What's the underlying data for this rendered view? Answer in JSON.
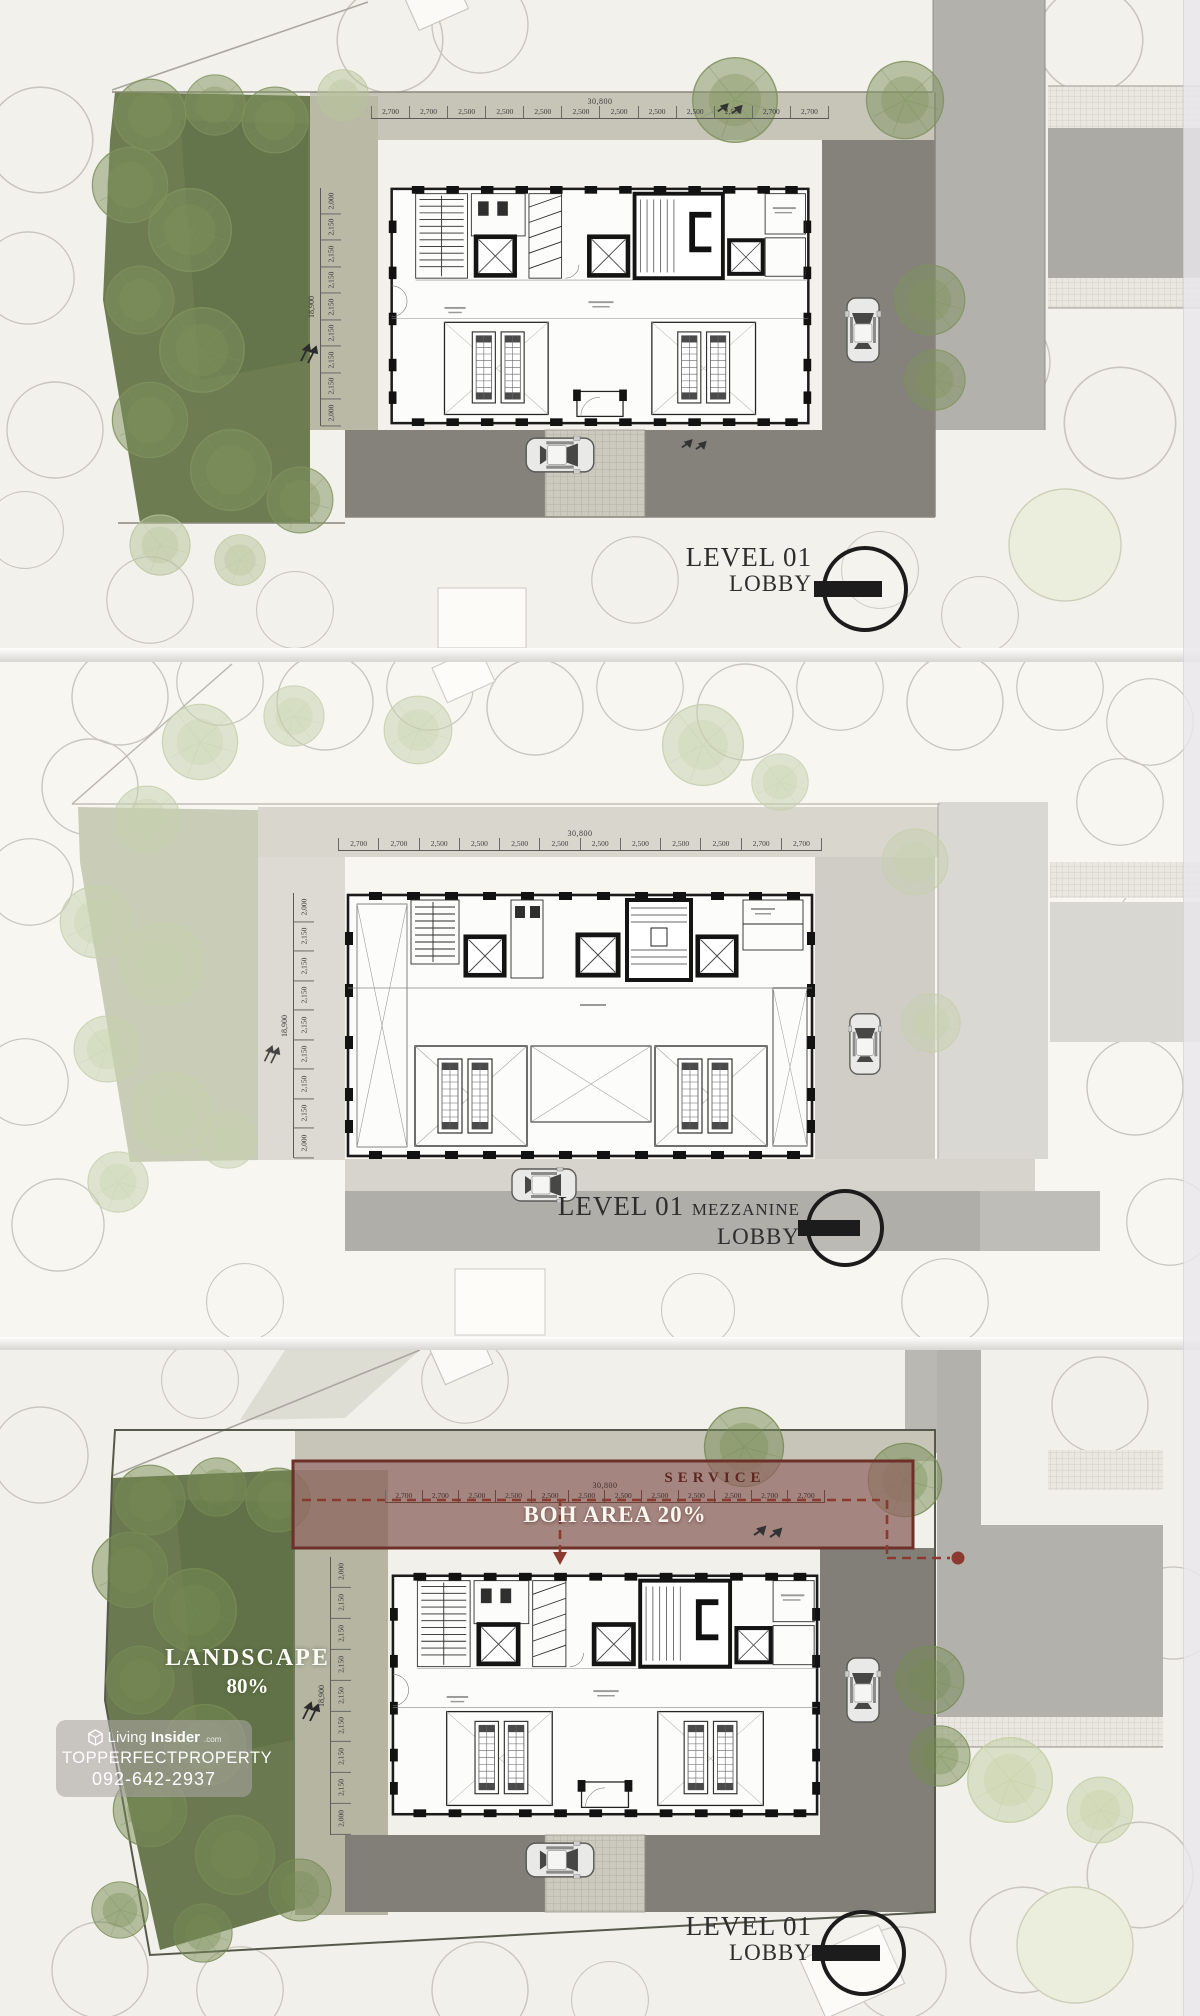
{
  "document": {
    "type": "architectural site and floor plan sheet",
    "sheet_count": "3 stacked plan panels"
  },
  "dimensions": {
    "top": {
      "overall": "30,800",
      "segments": [
        "2,700",
        "2,700",
        "2,500",
        "2,500",
        "2,500",
        "2,500",
        "2,500",
        "2,500",
        "2,500",
        "2,500",
        "2,700",
        "2,700"
      ]
    },
    "side": {
      "overall": "18,900",
      "segments": [
        "2,000",
        "2,150",
        "2,150",
        "2,150",
        "2,150",
        "2,150",
        "2,150",
        "2,150",
        "2,000"
      ]
    }
  },
  "panels": [
    {
      "id": "level01-lobby",
      "title_line1": "LEVEL 01",
      "title_line2": "LOBBY"
    },
    {
      "id": "level01-mezzanine-lobby",
      "title_line1": "LEVEL 01",
      "title_mezzanine": "MEZZANINE",
      "title_line2": "LOBBY"
    },
    {
      "id": "level01-lobby-area-analysis",
      "title_line1": "LEVEL 01",
      "title_line2": "LOBBY",
      "landscape_label": "LANDSCAPE",
      "landscape_value": "80%",
      "service_label": "SERVICE",
      "boh_label": "BOH AREA 20%"
    }
  ],
  "watermark": {
    "brand_light": "Living",
    "brand_bold": "Insider",
    "brand_suffix": ".com",
    "line2": "TOPPERFECTPROPERTY",
    "line3": "092-642-2937"
  },
  "colors": {
    "background": "#f4f2ec",
    "landscape_green": "#6e7d51",
    "tree_green": "#7e925d",
    "driveway_gray": "#85827c",
    "road_gray": "#b3b1ac",
    "boh_band_fill": "#8e6760",
    "boh_accent_red": "#6d3129",
    "title_ink": "#2d2d2d"
  }
}
